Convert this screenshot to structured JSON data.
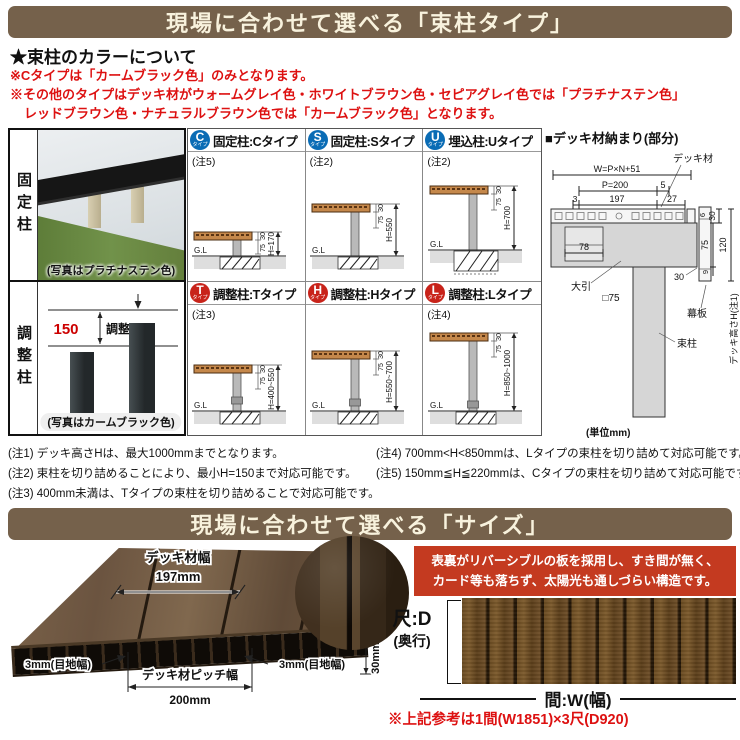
{
  "banner1": {
    "title": "現場に合わせて選べる「束柱タイプ」"
  },
  "banner2": {
    "title": "現場に合わせて選べる「サイズ」"
  },
  "colors": {
    "banner_bg": "#75614b",
    "banner_text": "#f8f2dd",
    "red_text": "#dd1111",
    "badge_blue": "#0a6cb5",
    "badge_red": "#c8231a",
    "red_box_bg": "#c43a20"
  },
  "color_section": {
    "heading": "★束柱のカラーについて",
    "line1": "※Cタイプは「カームブラック色」のみとなります。",
    "line2": "※その他のタイプはデッキ材がウォームグレイ色・ホワイトブラウン色・セピアグレイ色では「プラチナステン色」",
    "line3": "レッドブラウン色・ナチュラルブラウン色では「カームブラック色」となります。"
  },
  "photo_panel": {
    "fixed_label": "固定柱",
    "fixed_caption": "(写真はプラチナステン色)",
    "adjust_label": "調整柱",
    "adjust_value": "150",
    "adjust_word": "調整",
    "adjust_caption": "(写真はカームブラック色)"
  },
  "types": [
    {
      "badge": "C",
      "badge_sub": "タイプ",
      "title": "固定柱:Cタイプ",
      "note": "(注5)",
      "d30": "30",
      "d75": "75",
      "h": "H=170",
      "gl": "G.L"
    },
    {
      "badge": "S",
      "badge_sub": "タイプ",
      "title": "固定柱:Sタイプ",
      "note": "(注2)",
      "d30": "30",
      "d75": "75",
      "h": "H=550",
      "gl": "G.L"
    },
    {
      "badge": "U",
      "badge_sub": "タイプ",
      "title": "埋込柱:Uタイプ",
      "note": "(注2)",
      "d30": "30",
      "d75": "75",
      "h": "H=700",
      "gl": "G.L"
    },
    {
      "badge": "T",
      "badge_sub": "タイプ",
      "title": "調整柱:Tタイプ",
      "note": "(注3)",
      "d30": "30",
      "d75": "75",
      "h": "H=400~550",
      "gl": "G.L"
    },
    {
      "badge": "H",
      "badge_sub": "タイプ",
      "title": "調整柱:Hタイプ",
      "note": "",
      "d30": "30",
      "d75": "75",
      "h": "H=550~700",
      "gl": "G.L"
    },
    {
      "badge": "L",
      "badge_sub": "タイプ",
      "title": "調整柱:Lタイプ",
      "note": "(注4)",
      "d30": "30",
      "d75": "75",
      "h": "H=850~1000",
      "gl": "G.L"
    }
  ],
  "detail": {
    "heading": "■デッキ材納まり(部分)",
    "labels": {
      "deck": "デッキ材",
      "w": "W=P×N+51",
      "p": "P=200",
      "n5": "5",
      "n3": "3",
      "n197": "197",
      "n27": "27",
      "n6": "6",
      "n30top": "30",
      "n120": "120",
      "n75": "75",
      "n9": "9",
      "n30bot": "30",
      "n78": "78",
      "obiki": "大引",
      "sq75": "□75",
      "makuita": "幕板",
      "tsukabashira": "束柱",
      "deck_height": "デッキ高さH(注1)",
      "unit": "(単位mm)"
    }
  },
  "notes": [
    "(注1) デッキ高さHは、最大1000mmまでとなります。",
    "(注2) 束柱を切り詰めることにより、最小H=150まで対応可能です。",
    "(注3) 400mm未満は、Tタイプの束柱を切り詰めることで対応可能です。",
    "(注4) 700mm<H<850mmは、Lタイプの束柱を切り詰めて対応可能です。",
    "(注5) 150mm≦H≦220mmは、Cタイプの束柱を切り詰めて対応可能です。"
  ],
  "size": {
    "deck_width_label": "デッキ材幅",
    "deck_width_value": "197mm",
    "joint_left": "3mm(目地幅)",
    "joint_right": "3mm(目地幅)",
    "pitch_label": "デッキ材ピッチ幅",
    "pitch_value": "200mm",
    "thickness": "30mm",
    "box_line1": "表裏がリバーシブルの板を採用し、すき間が無く、",
    "box_line2": "カード等も落ちず、太陽光も通しづらい構造です。",
    "depth_line1": "尺:D",
    "depth_line2": "(奥行)",
    "width_label": "間:W(幅)",
    "ref_note": "※上記参考は1間(W1851)×3尺(D920)"
  }
}
